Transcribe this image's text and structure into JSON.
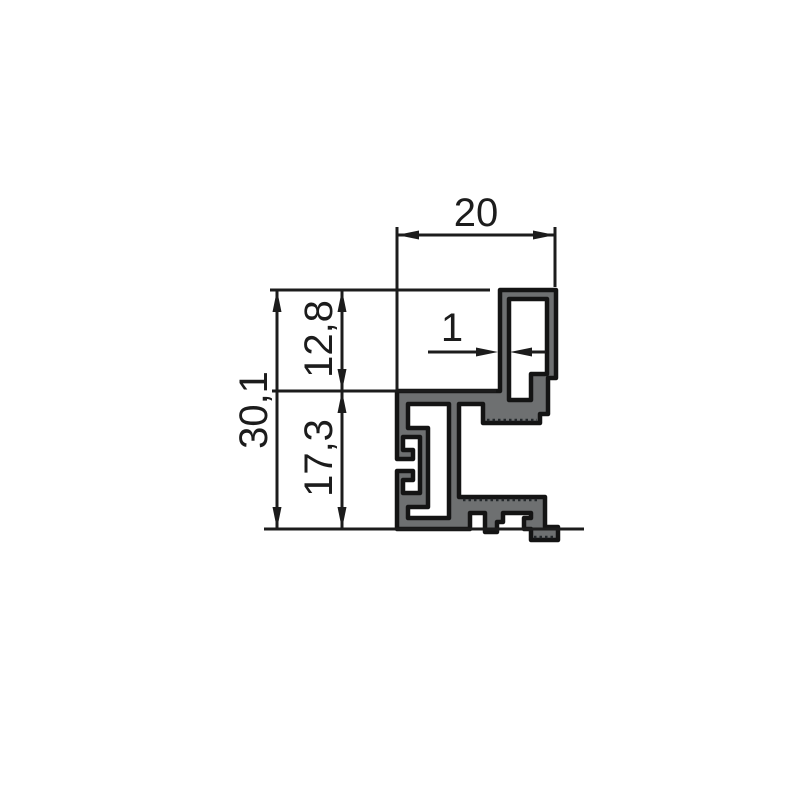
{
  "drawing": {
    "kind": "profile-cross-section",
    "dimensions": {
      "overall_width": "20",
      "wall_thickness": "1",
      "overall_height": "30,1",
      "upper_height": "12,8",
      "lower_height": "17,3"
    }
  },
  "colors": {
    "background": "#ffffff",
    "line": "#1c1c1c",
    "material_fill": "#6e7071",
    "outline": "#141414"
  }
}
